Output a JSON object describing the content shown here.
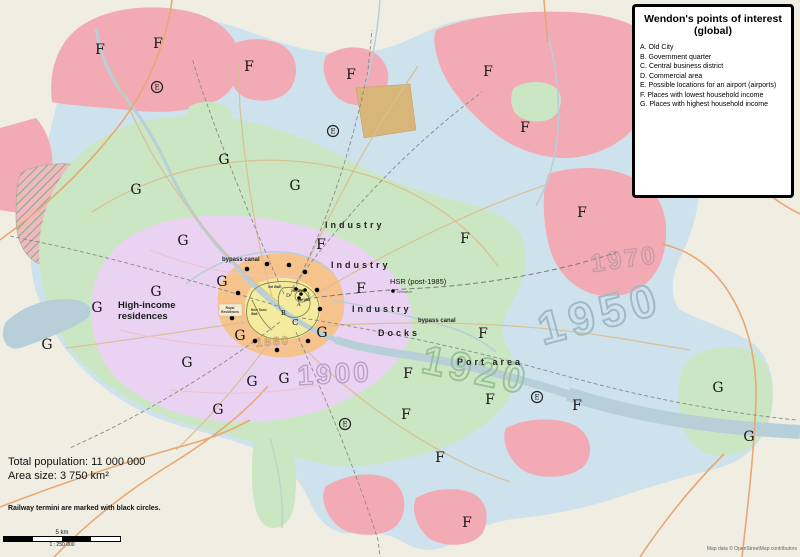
{
  "legend": {
    "title": "Wendon's points of interest (global)",
    "items": [
      "A. Old City",
      "B. Government quarter",
      "C. Central business district",
      "D. Commercial area",
      "E. Possible locations for an airport (airports)",
      "F. Places with lowest household income",
      "G. Places with highest household income"
    ]
  },
  "stats": {
    "population": "Total population: 11 000 000",
    "area": "Area size: 3 750 km²",
    "note": "Railway termini are marked with black circles."
  },
  "scalebar": {
    "distance": "5 km",
    "ratio": "1 : 250 000"
  },
  "attribution": "Map data © OpenStreetMap contributors",
  "markers": {
    "f": "F",
    "g": "G",
    "airport": "E"
  },
  "years": {
    "y1880": "1880",
    "y1900": "1900",
    "y1920": "1920",
    "y1950": "1950",
    "y1970": "1970"
  },
  "labels": {
    "industry": "Industry",
    "docks": "Docks",
    "port_area": "Port area",
    "bypass_canal": "bypass canal",
    "hsr": "HSR (post-1985)",
    "hsr_station": "Wendon",
    "high_income_line1": "High-income",
    "high_income_line2": "residences",
    "royal_line1": "Royal",
    "royal_line2": "Residences",
    "new_town_line1": "New Town",
    "new_town_line2": "Wall",
    "wall_3rd": "3rd Wall",
    "wall_2nd": "2nd Wall",
    "wall_1st": "1st Wall",
    "poi_a": "A",
    "poi_b": "B",
    "poi_c": "C",
    "poi_d": "D"
  }
}
